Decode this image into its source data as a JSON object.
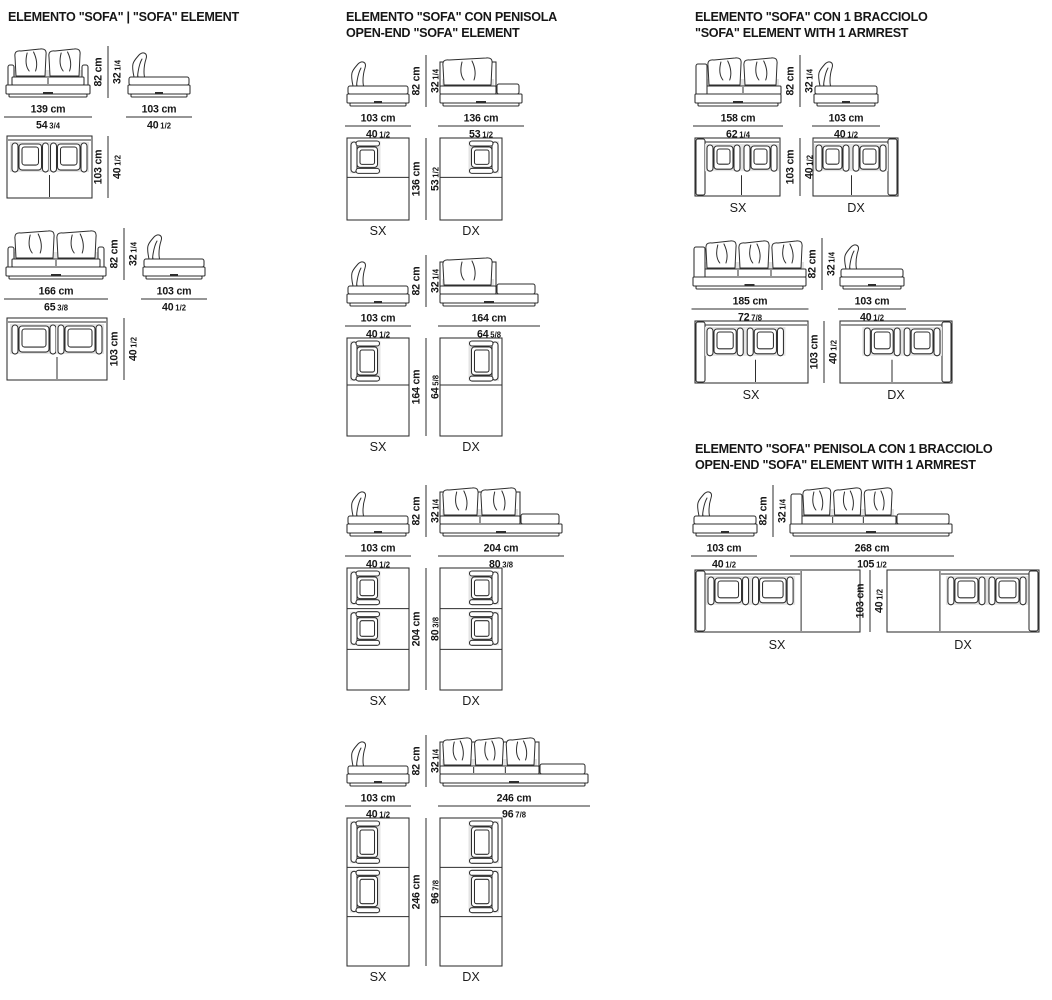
{
  "page": {
    "bg": "#ffffff",
    "ink": "#2e2e2e",
    "shade": "#e4e4e4"
  },
  "sections": [
    {
      "key": "sofa-element",
      "title_lines": [
        "ELEMENTO \"SOFA\" | \"SOFA\" ELEMENT"
      ],
      "groups": [
        {
          "front_w_cm": "139 cm",
          "front_w_in": {
            "whole": "54",
            "frac": "3/4"
          },
          "side_w_cm": "103 cm",
          "side_w_in": {
            "whole": "40",
            "frac": "1/2"
          },
          "h_cm": "82 cm",
          "h_in": {
            "whole": "32",
            "frac": "1/4"
          },
          "plan_d_cm": "103 cm",
          "plan_d_in": {
            "whole": "40",
            "frac": "1/2"
          }
        },
        {
          "front_w_cm": "166 cm",
          "front_w_in": {
            "whole": "65",
            "frac": "3/8"
          },
          "side_w_cm": "103 cm",
          "side_w_in": {
            "whole": "40",
            "frac": "1/2"
          },
          "h_cm": "82 cm",
          "h_in": {
            "whole": "32",
            "frac": "1/4"
          },
          "plan_d_cm": "103 cm",
          "plan_d_in": {
            "whole": "40",
            "frac": "1/2"
          }
        }
      ]
    },
    {
      "key": "sofa-open-end",
      "title_lines": [
        "ELEMENTO \"SOFA\" CON PENISOLA",
        "OPEN-END \"SOFA\" ELEMENT"
      ],
      "groups": [
        {
          "side_w_cm": "103 cm",
          "side_w_in": {
            "whole": "40",
            "frac": "1/2"
          },
          "front_w_cm": "136 cm",
          "front_w_in": {
            "whole": "53",
            "frac": "1/2"
          },
          "h_cm": "82 cm",
          "h_in": {
            "whole": "32",
            "frac": "1/4"
          },
          "plan_d_cm": "136 cm",
          "plan_d_in": {
            "whole": "53",
            "frac": "1/2"
          },
          "plan_labels": [
            "SX",
            "DX"
          ]
        },
        {
          "side_w_cm": "103 cm",
          "side_w_in": {
            "whole": "40",
            "frac": "1/2"
          },
          "front_w_cm": "164 cm",
          "front_w_in": {
            "whole": "64",
            "frac": "5/8"
          },
          "h_cm": "82 cm",
          "h_in": {
            "whole": "32",
            "frac": "1/4"
          },
          "plan_d_cm": "164 cm",
          "plan_d_in": {
            "whole": "64",
            "frac": "5/8"
          },
          "plan_labels": [
            "SX",
            "DX"
          ]
        },
        {
          "side_w_cm": "103 cm",
          "side_w_in": {
            "whole": "40",
            "frac": "1/2"
          },
          "front_w_cm": "204 cm",
          "front_w_in": {
            "whole": "80",
            "frac": "3/8"
          },
          "h_cm": "82 cm",
          "h_in": {
            "whole": "32",
            "frac": "1/4"
          },
          "plan_d_cm": "204 cm",
          "plan_d_in": {
            "whole": "80",
            "frac": "3/8"
          },
          "plan_labels": [
            "SX",
            "DX"
          ]
        },
        {
          "side_w_cm": "103 cm",
          "side_w_in": {
            "whole": "40",
            "frac": "1/2"
          },
          "front_w_cm": "246 cm",
          "front_w_in": {
            "whole": "96",
            "frac": "7/8"
          },
          "h_cm": "82 cm",
          "h_in": {
            "whole": "32",
            "frac": "1/4"
          },
          "plan_d_cm": "246 cm",
          "plan_d_in": {
            "whole": "96",
            "frac": "7/8"
          },
          "plan_labels": [
            "SX",
            "DX"
          ]
        }
      ]
    },
    {
      "key": "sofa-1-armrest",
      "title_lines": [
        "ELEMENTO \"SOFA\" CON 1 BRACCIOLO",
        "\"SOFA\" ELEMENT WITH 1 ARMREST"
      ],
      "groups": [
        {
          "front_w_cm": "158 cm",
          "front_w_in": {
            "whole": "62",
            "frac": "1/4"
          },
          "side_w_cm": "103 cm",
          "side_w_in": {
            "whole": "40",
            "frac": "1/2"
          },
          "h_cm": "82 cm",
          "h_in": {
            "whole": "32",
            "frac": "1/4"
          },
          "plan_d_cm": "103 cm",
          "plan_d_in": {
            "whole": "40",
            "frac": "1/2"
          },
          "plan_labels": [
            "SX",
            "DX"
          ]
        },
        {
          "front_w_cm": "185 cm",
          "front_w_in": {
            "whole": "72",
            "frac": "7/8"
          },
          "side_w_cm": "103 cm",
          "side_w_in": {
            "whole": "40",
            "frac": "1/2"
          },
          "h_cm": "82 cm",
          "h_in": {
            "whole": "32",
            "frac": "1/4"
          },
          "plan_d_cm": "103 cm",
          "plan_d_in": {
            "whole": "40",
            "frac": "1/2"
          },
          "plan_labels": [
            "SX",
            "DX"
          ]
        }
      ]
    },
    {
      "key": "sofa-open-end-1-armrest",
      "title_lines": [
        "ELEMENTO \"SOFA\" PENISOLA CON 1 BRACCIOLO",
        "OPEN-END \"SOFA\" ELEMENT WITH 1 ARMREST"
      ],
      "groups": [
        {
          "side_w_cm": "103 cm",
          "side_w_in": {
            "whole": "40",
            "frac": "1/2"
          },
          "front_w_cm": "268 cm",
          "front_w_in": {
            "whole": "105",
            "frac": "1/2"
          },
          "h_cm": "82 cm",
          "h_in": {
            "whole": "32",
            "frac": "1/4"
          },
          "plan_d_cm": "103 cm",
          "plan_d_in": {
            "whole": "40",
            "frac": "1/2"
          },
          "plan_labels": [
            "SX",
            "DX"
          ]
        }
      ]
    }
  ]
}
